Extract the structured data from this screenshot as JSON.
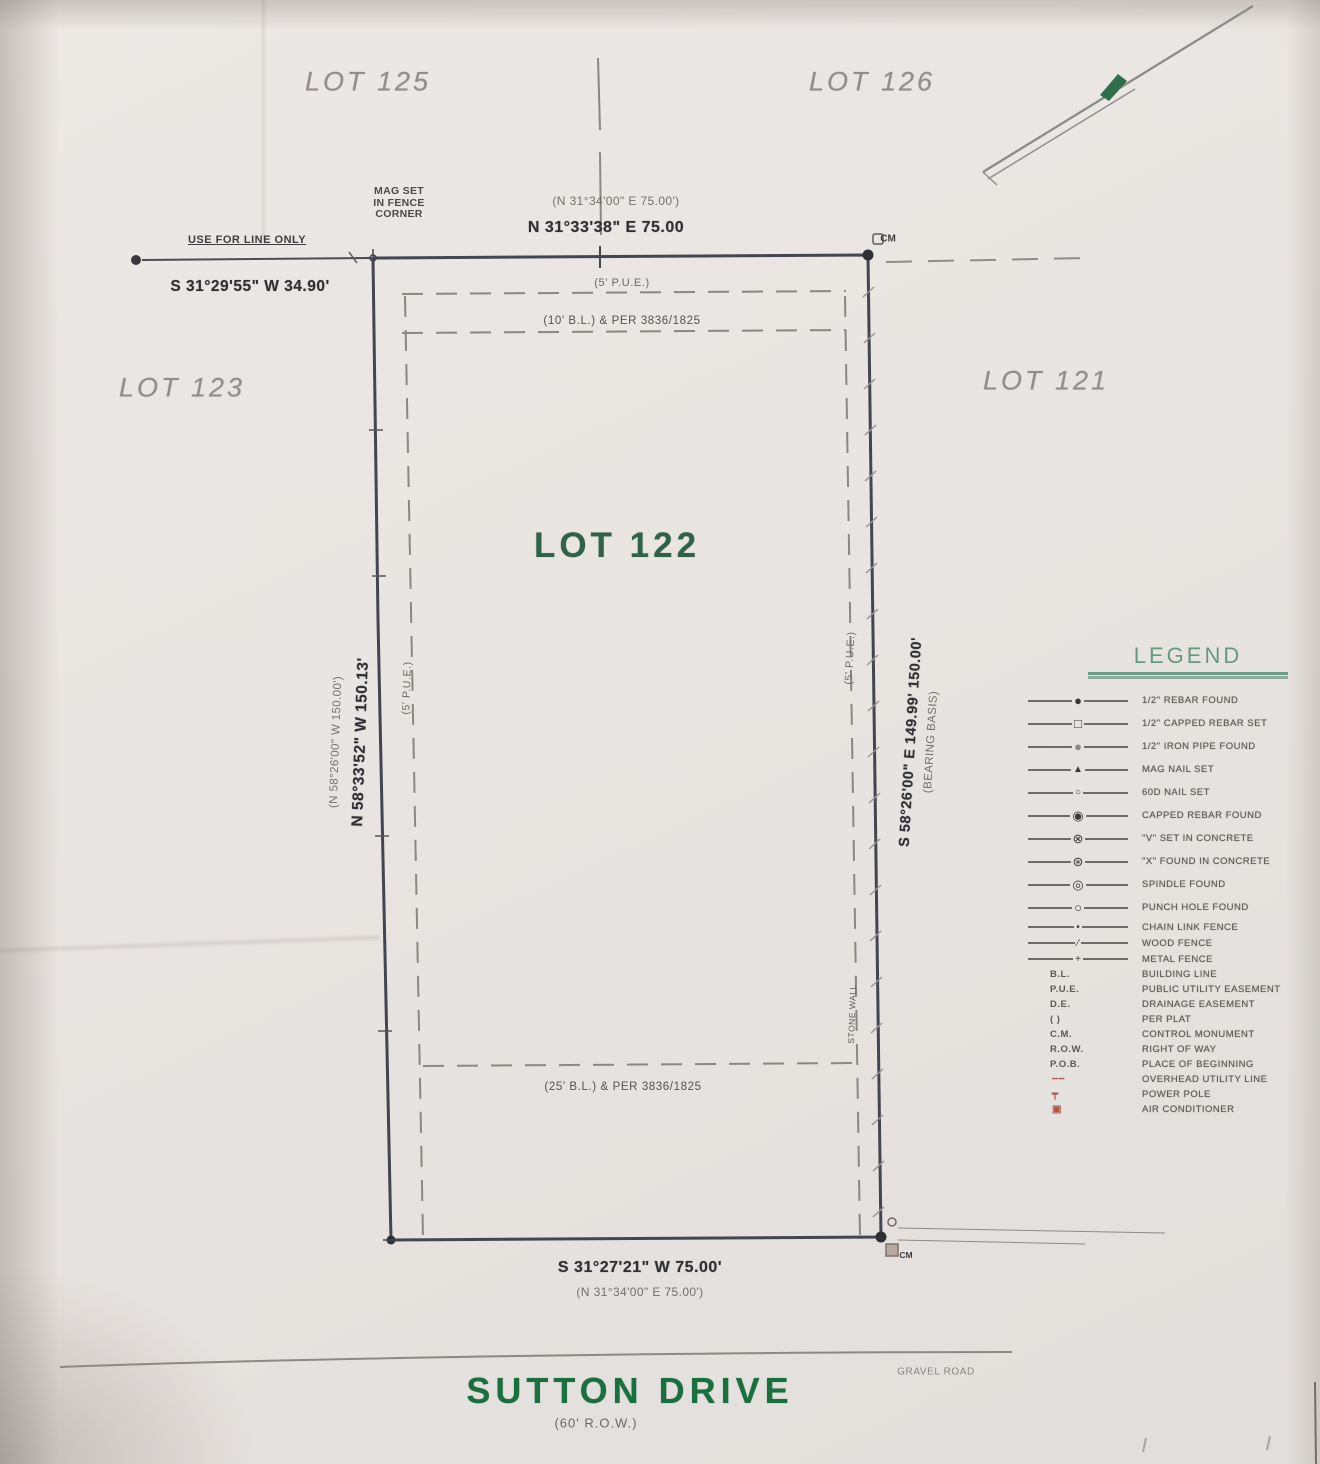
{
  "lots": {
    "current": "LOT 122",
    "top_left": "LOT 125",
    "top_right": "LOT 126",
    "left": "LOT 123",
    "right": "LOT 121"
  },
  "boundaries": {
    "top": {
      "measured": "N 31°33'38\" E 75.00",
      "record": "(N 31°34'00\" E 75.00')"
    },
    "bottom": {
      "measured": "S 31°27'21\" W 75.00'",
      "record": "(N 31°34'00\" E 75.00')"
    },
    "left": {
      "measured": "N 58°33'52\" W 150.13'",
      "record": "(N 58°26'00\" W 150.00')"
    },
    "right": {
      "measured": "S 58°26'00\" E 149.99' 150.00'",
      "note": "(BEARING BASIS)"
    }
  },
  "annotations": {
    "tie_label": "USE FOR LINE ONLY",
    "tie_bearing": "S 31°29'55\" W 34.90'",
    "mag_set_line1": "MAG SET",
    "mag_set_line2": "IN FENCE",
    "mag_set_line3": "CORNER",
    "cm_top": "CM",
    "cm_bottom": "CM",
    "pue_top": "(5' P.U.E.)",
    "pue_left": "(5' P.U.E.)",
    "pue_right": "(5' P.U.E.)",
    "bl_top": "(10' B.L.) & PER 3836/1825",
    "bl_bottom": "(25' B.L.) & PER 3836/1825",
    "stone_wall": "STONE WALL"
  },
  "road": {
    "name": "SUTTON DRIVE",
    "row": "(60' R.O.W.)",
    "surface": "GRAVEL ROAD"
  },
  "legend": {
    "title": "LEGEND",
    "items": [
      {
        "glyph": "●",
        "label": "1/2\" REBAR FOUND"
      },
      {
        "glyph": "□",
        "label": "1/2\" CAPPED REBAR SET"
      },
      {
        "glyph": "●",
        "label": "1/2\" IRON PIPE FOUND"
      },
      {
        "glyph": "▲",
        "label": "MAG NAIL SET"
      },
      {
        "glyph": "○",
        "label": "60D NAIL SET"
      },
      {
        "glyph": "◉",
        "label": "CAPPED REBAR FOUND"
      },
      {
        "glyph": "⊗",
        "label": "\"V\" SET IN CONCRETE"
      },
      {
        "glyph": "⊛",
        "label": "\"X\" FOUND IN CONCRETE"
      },
      {
        "glyph": "◎",
        "label": "SPINDLE FOUND"
      },
      {
        "glyph": "○",
        "label": "PUNCH HOLE FOUND"
      },
      {
        "glyph": "•",
        "label": "CHAIN LINK FENCE"
      },
      {
        "glyph": "∕",
        "label": "WOOD FENCE"
      },
      {
        "glyph": "+",
        "label": "METAL FENCE"
      },
      {
        "abbr": "B.L.",
        "label": "BUILDING LINE"
      },
      {
        "abbr": "P.U.E.",
        "label": "PUBLIC UTILITY EASEMENT"
      },
      {
        "abbr": "D.E.",
        "label": "DRAINAGE EASEMENT"
      },
      {
        "abbr": "( )",
        "label": "PER PLAT"
      },
      {
        "abbr": "C.M.",
        "label": "CONTROL MONUMENT"
      },
      {
        "abbr": "R.O.W.",
        "label": "RIGHT OF WAY"
      },
      {
        "abbr": "P.O.B.",
        "label": "PLACE OF BEGINNING"
      },
      {
        "glyph": "╌╌",
        "label": "OVERHEAD UTILITY LINE"
      },
      {
        "glyph": "┯",
        "label": "POWER POLE"
      },
      {
        "glyph": "▣",
        "label": "AIR CONDITIONER"
      }
    ]
  },
  "colors": {
    "road_green": "#1a6f3f",
    "lot_green": "#31604b",
    "legend_green": "#4e8e72",
    "line_dark": "#434551",
    "red_symbol": "#b0574a"
  }
}
